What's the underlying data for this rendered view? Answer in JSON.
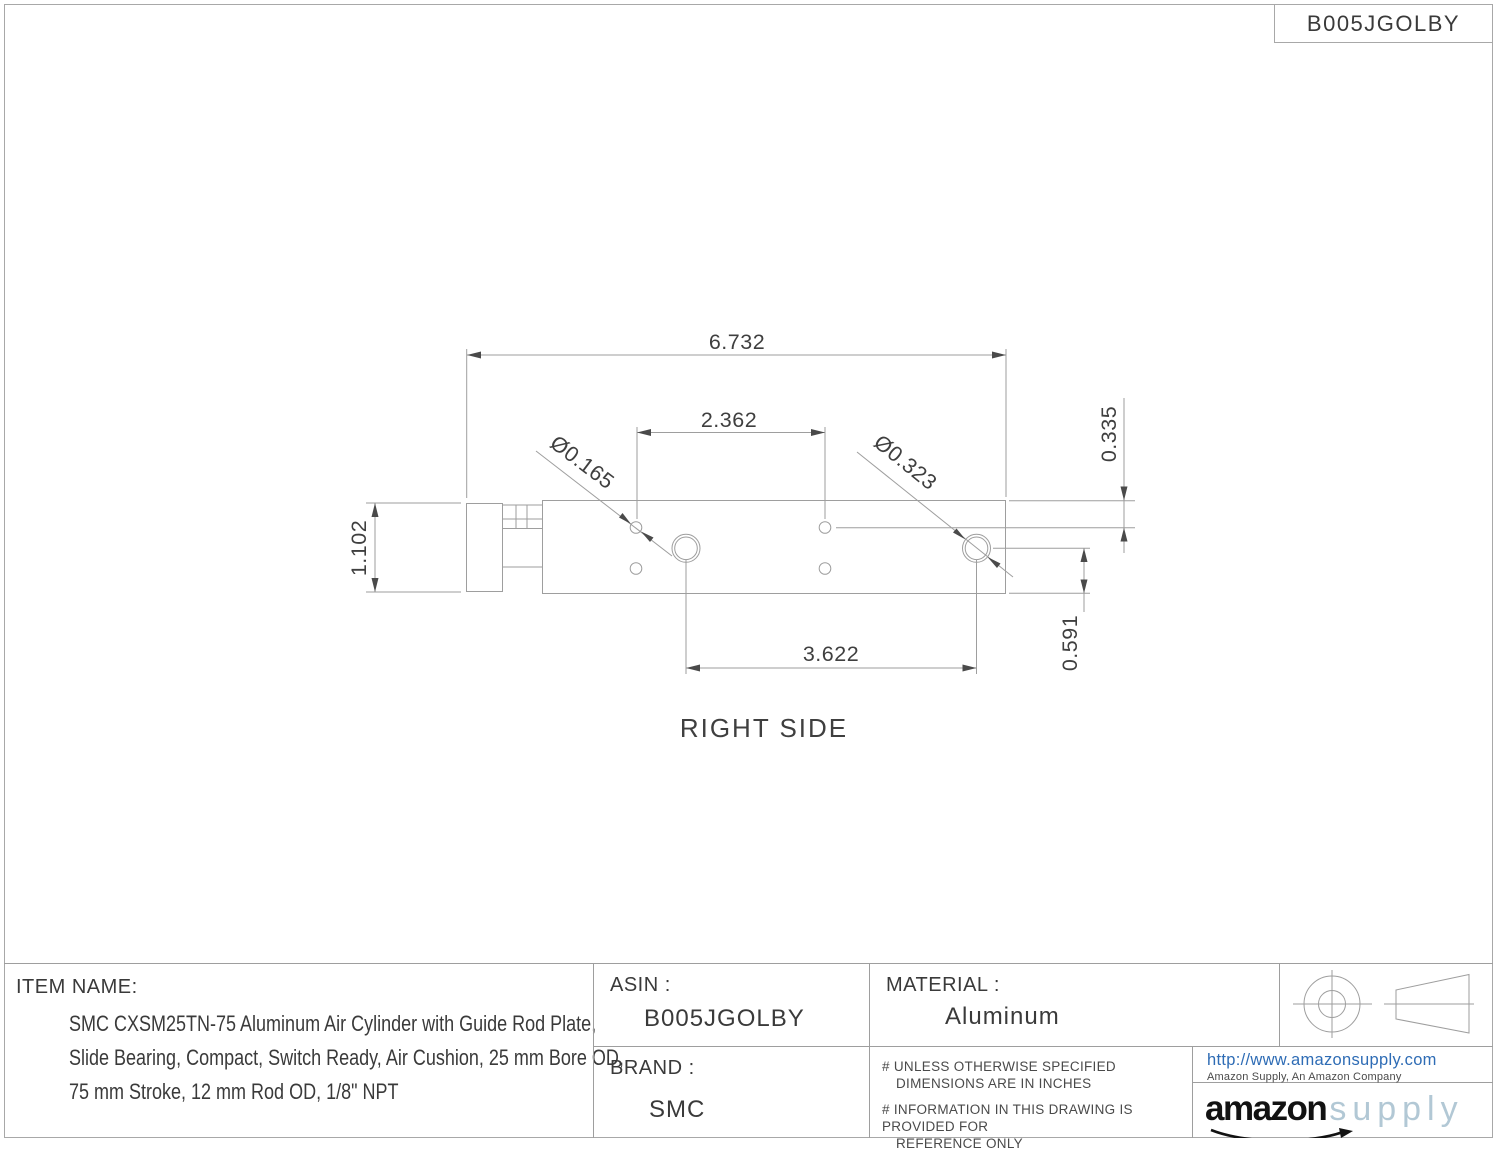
{
  "page": {
    "asin_box": "B005JGOLBY",
    "view_label": "RIGHT SIDE"
  },
  "drawing": {
    "dims": {
      "overall_length": "6.732",
      "top_hole_spacing": "2.362",
      "bottom_hole_spacing": "3.622",
      "body_height": "1.102",
      "top_hole_offset": "0.335",
      "bottom_hole_offset": "0.591",
      "small_hole_dia": "Ø0.165",
      "large_hole_dia": "Ø0.323"
    }
  },
  "title_block": {
    "item_name_label": "ITEM NAME:",
    "item_name_line1": "SMC CXSM25TN-75 Aluminum Air Cylinder with Guide Rod Plate,",
    "item_name_line2": "Slide Bearing, Compact, Switch Ready, Air Cushion, 25 mm Bore OD,",
    "item_name_line3": "75 mm Stroke, 12 mm Rod OD, 1/8\" NPT",
    "asin_label": "ASIN :",
    "asin_value": "B005JGOLBY",
    "brand_label": "BRAND :",
    "brand_value": "SMC",
    "material_label": "MATERIAL :",
    "material_value": "Aluminum",
    "note1_line1": "# UNLESS OTHERWISE SPECIFIED",
    "note1_line2": "DIMENSIONS ARE IN INCHES",
    "note2_line1": "# INFORMATION IN THIS DRAWING IS PROVIDED FOR",
    "note2_line2": "REFERENCE ONLY",
    "company_url": "http://www.amazonsupply.com",
    "company_tagline": "Amazon Supply, An Amazon Company",
    "logo_primary": "amazon",
    "logo_secondary": "supply"
  },
  "colors": {
    "drawing_line": "#9e9e9e",
    "text": "#3f3f3f",
    "url_blue": "#2e6cb5",
    "logo_supply_blue": "#b2c8d5",
    "logo_black": "#121212"
  }
}
